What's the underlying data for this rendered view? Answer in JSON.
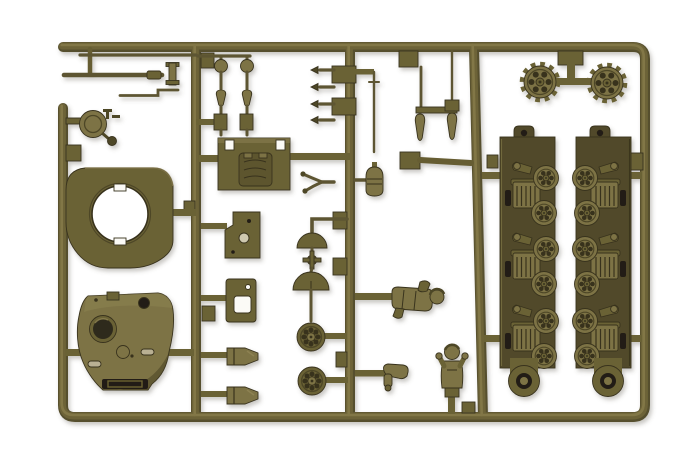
{
  "image": {
    "type": "photograph",
    "subject": "Olive drab injection-molded plastic model kit sprue with armored vehicle (tank) parts on a white background",
    "background": "white seamless backdrop",
    "text_visible": "none"
  },
  "palette": {
    "bg": "#ffffff",
    "olive-deep": "#39331e",
    "olive-dark": "#4e4628",
    "olive-mid": "#6b6236",
    "olive-light": "#7d7345",
    "olive-hi": "#8d8252",
    "plate": "#514a2a",
    "hole-dark": "#241f12",
    "cut-white": "#fbfaf6"
  },
  "parts": {
    "frame": {
      "label": "Plastic sprue frame runners"
    },
    "gun_barrel": {
      "label": "Tank gun barrel pieces"
    },
    "hatch": {
      "label": "Commander's hatch disc with fittings"
    },
    "turret_ring": {
      "label": "Turret ring plate with circular opening"
    },
    "turret": {
      "label": "Tank turret shell with cupola and mantlet slot"
    },
    "deck_plate": {
      "label": "Engine deck hatch plate"
    },
    "periscopes": {
      "label": "Periscope and light fittings"
    },
    "cone_fittings": {
      "label": "Cone-tipped valve fittings"
    },
    "antenna": {
      "label": "Antenna rod"
    },
    "fittings": {
      "label": "Small hull fittings and smoke candles"
    },
    "sprockets": {
      "label": "Toothed drive sprocket wheels"
    },
    "left_rack": {
      "label": "Left suspension rack with three bogie units"
    },
    "right_rack": {
      "label": "Right suspension rack with three bogie units"
    },
    "panel_a": {
      "label": "Hatch panel with drilled holes"
    },
    "panel_b": {
      "label": "Hatch panel with slot opening"
    },
    "shackles": {
      "label": "Tow shackle lugs"
    },
    "domes": {
      "label": "Ventilator dome halves and hub cap"
    },
    "road_wheels": {
      "label": "Spare spoked road wheels"
    },
    "tow_fork": {
      "label": "Towing clevis fork"
    },
    "pack": {
      "label": "Stowage pack cylinder"
    },
    "loader": {
      "label": "Reclining crew figure"
    },
    "arm": {
      "label": "Spare crew figure arm"
    },
    "commander": {
      "label": "Commander half-figure with raised arms"
    }
  }
}
